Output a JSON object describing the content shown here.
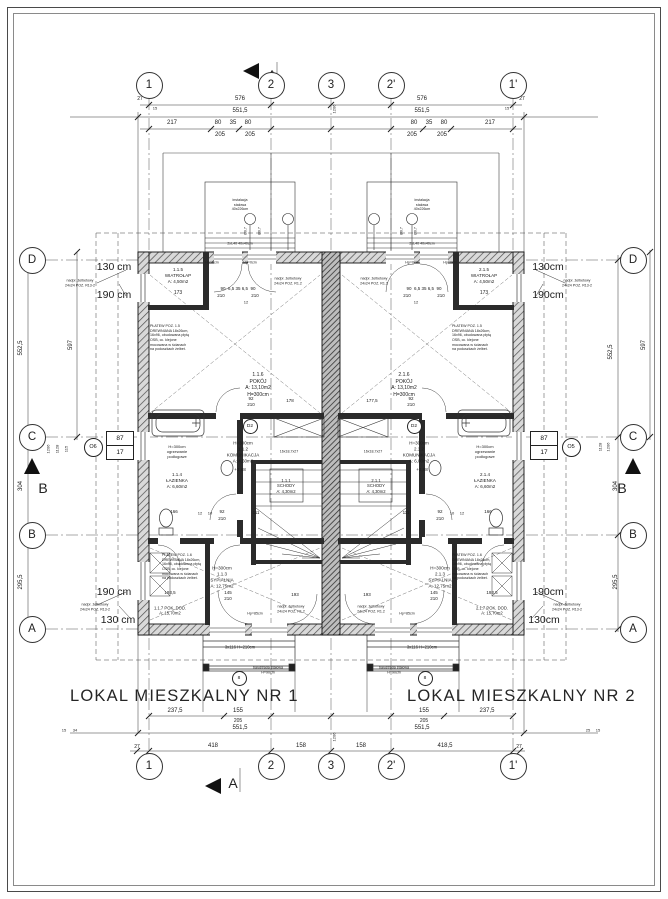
{
  "titles": {
    "nr1": "LOKAL MIESZKALNY NR 1",
    "nr2": "LOKAL MIESZKALNY  NR 2"
  },
  "axis_markers": {
    "top": [
      {
        "t": "1",
        "x": 149,
        "y": 85
      },
      {
        "t": "2",
        "x": 271,
        "y": 85
      },
      {
        "t": "3",
        "x": 331,
        "y": 85
      },
      {
        "t": "2'",
        "x": 391,
        "y": 85
      },
      {
        "t": "1'",
        "x": 513,
        "y": 85
      }
    ],
    "bottom": [
      {
        "t": "1",
        "x": 149,
        "y": 766
      },
      {
        "t": "2",
        "x": 271,
        "y": 766
      },
      {
        "t": "3",
        "x": 331,
        "y": 766
      },
      {
        "t": "2'",
        "x": 391,
        "y": 766
      },
      {
        "t": "1'",
        "x": 513,
        "y": 766
      }
    ],
    "left": [
      {
        "t": "D",
        "x": 32,
        "y": 260
      },
      {
        "t": "C",
        "x": 32,
        "y": 437
      },
      {
        "t": "B",
        "x": 32,
        "y": 535
      },
      {
        "t": "A",
        "x": 32,
        "y": 629
      }
    ],
    "right": [
      {
        "t": "D",
        "x": 633,
        "y": 260
      },
      {
        "t": "C",
        "x": 633,
        "y": 437
      },
      {
        "t": "B",
        "x": 633,
        "y": 535
      },
      {
        "t": "A",
        "x": 633,
        "y": 629
      }
    ]
  },
  "section_labels": [
    {
      "t": "A",
      "x": 272,
      "y": 75
    },
    {
      "t": "A",
      "x": 233,
      "y": 783
    },
    {
      "t": "B",
      "x": 43,
      "y": 488
    },
    {
      "t": "B",
      "x": 622,
      "y": 488
    }
  ],
  "contours": [
    {
      "t": "130 cm",
      "x": 114,
      "y": 268,
      "s": 10.5
    },
    {
      "t": "190 cm",
      "x": 114,
      "y": 296,
      "s": 10.5
    },
    {
      "t": "130cm",
      "x": 548,
      "y": 268,
      "s": 10.5
    },
    {
      "t": "190cm",
      "x": 548,
      "y": 296,
      "s": 10.5
    },
    {
      "t": "190 cm",
      "x": 114,
      "y": 593,
      "s": 10.5
    },
    {
      "t": "130 cm",
      "x": 118,
      "y": 621,
      "s": 10.5
    },
    {
      "t": "190cm",
      "x": 548,
      "y": 593,
      "s": 10.5
    },
    {
      "t": "130cm",
      "x": 544,
      "y": 621,
      "s": 10.5
    }
  ],
  "dimensions": [
    {
      "t": "576",
      "x": 240,
      "y": 100,
      "s": 6
    },
    {
      "t": "576",
      "x": 422,
      "y": 100,
      "s": 6
    },
    {
      "t": "551,5",
      "x": 240,
      "y": 112,
      "s": 6
    },
    {
      "t": "551,5",
      "x": 422,
      "y": 112,
      "s": 6
    },
    {
      "t": "27",
      "x": 140,
      "y": 99,
      "s": 5
    },
    {
      "t": "15",
      "x": 155,
      "y": 108,
      "s": 4
    },
    {
      "t": "1206",
      "x": 334,
      "y": 109,
      "s": 4,
      "r": -90
    },
    {
      "t": "15",
      "x": 507,
      "y": 108,
      "s": 4
    },
    {
      "t": "27",
      "x": 522,
      "y": 99,
      "s": 5
    },
    {
      "t": "217",
      "x": 172,
      "y": 124,
      "s": 6
    },
    {
      "t": "80",
      "x": 218,
      "y": 124,
      "s": 6
    },
    {
      "t": "35",
      "x": 233,
      "y": 124,
      "s": 6
    },
    {
      "t": "80",
      "x": 248,
      "y": 124,
      "s": 6
    },
    {
      "t": "80",
      "x": 414,
      "y": 124,
      "s": 6
    },
    {
      "t": "35",
      "x": 429,
      "y": 124,
      "s": 6
    },
    {
      "t": "80",
      "x": 444,
      "y": 124,
      "s": 6
    },
    {
      "t": "217",
      "x": 490,
      "y": 124,
      "s": 6
    },
    {
      "t": "205",
      "x": 220,
      "y": 136,
      "s": 6
    },
    {
      "t": "205",
      "x": 250,
      "y": 136,
      "s": 6
    },
    {
      "t": "205",
      "x": 412,
      "y": 136,
      "s": 6
    },
    {
      "t": "205",
      "x": 442,
      "y": 136,
      "s": 6
    },
    {
      "t": "237,5",
      "x": 175,
      "y": 712,
      "s": 6
    },
    {
      "t": "155",
      "x": 238,
      "y": 712,
      "s": 6
    },
    {
      "t": "155",
      "x": 424,
      "y": 712,
      "s": 6
    },
    {
      "t": "237,5",
      "x": 487,
      "y": 712,
      "s": 6
    },
    {
      "t": "205",
      "x": 238,
      "y": 721,
      "s": 5
    },
    {
      "t": "205",
      "x": 424,
      "y": 721,
      "s": 5
    },
    {
      "t": "551,5",
      "x": 240,
      "y": 729,
      "s": 6
    },
    {
      "t": "551,5",
      "x": 422,
      "y": 729,
      "s": 6
    },
    {
      "t": "1206",
      "x": 334,
      "y": 737,
      "s": 4,
      "r": -90
    },
    {
      "t": "15",
      "x": 64,
      "y": 730,
      "s": 4
    },
    {
      "t": "34",
      "x": 75,
      "y": 730,
      "s": 4
    },
    {
      "t": "25",
      "x": 588,
      "y": 730,
      "s": 4
    },
    {
      "t": "15",
      "x": 598,
      "y": 730,
      "s": 4
    },
    {
      "t": "27",
      "x": 137,
      "y": 747,
      "s": 5
    },
    {
      "t": "418",
      "x": 213,
      "y": 747,
      "s": 6
    },
    {
      "t": "158",
      "x": 301,
      "y": 747,
      "s": 6
    },
    {
      "t": "158",
      "x": 361,
      "y": 747,
      "s": 6
    },
    {
      "t": "418,5",
      "x": 445,
      "y": 747,
      "s": 6
    },
    {
      "t": "27",
      "x": 519,
      "y": 747,
      "s": 5
    },
    {
      "t": "552,5",
      "x": 22,
      "y": 348,
      "s": 6,
      "r": -90
    },
    {
      "t": "304",
      "x": 22,
      "y": 486,
      "s": 6,
      "r": -90
    },
    {
      "t": "295,5",
      "x": 22,
      "y": 582,
      "s": 6,
      "r": -90
    },
    {
      "t": "597",
      "x": 72,
      "y": 345,
      "s": 6,
      "r": -90
    },
    {
      "t": "115",
      "x": 66,
      "y": 449,
      "s": 4,
      "r": -90
    },
    {
      "t": "1128",
      "x": 57,
      "y": 449,
      "s": 4,
      "r": -90
    },
    {
      "t": "1206",
      "x": 48,
      "y": 449,
      "s": 4,
      "r": -90
    },
    {
      "t": "552,5",
      "x": 612,
      "y": 352,
      "s": 6,
      "r": -90
    },
    {
      "t": "597",
      "x": 645,
      "y": 345,
      "s": 6,
      "r": -90
    },
    {
      "t": "304",
      "x": 617,
      "y": 486,
      "s": 6,
      "r": -90
    },
    {
      "t": "295,5",
      "x": 617,
      "y": 582,
      "s": 6,
      "r": -90
    },
    {
      "t": "1128",
      "x": 600,
      "y": 447,
      "s": 4,
      "r": -90
    },
    {
      "t": "1206",
      "x": 608,
      "y": 447,
      "s": 4,
      "r": -90
    },
    {
      "t": "173",
      "x": 178,
      "y": 293,
      "s": 5
    },
    {
      "t": "173",
      "x": 484,
      "y": 293,
      "s": 5
    },
    {
      "t": "90  6,5 35 6,5  90",
      "x": 238,
      "y": 289,
      "s": 4.5
    },
    {
      "t": "90  6,5 35 6,5  90",
      "x": 424,
      "y": 289,
      "s": 4.5
    },
    {
      "t": "210",
      "x": 221,
      "y": 296,
      "s": 4.5
    },
    {
      "t": "210",
      "x": 255,
      "y": 296,
      "s": 4.5
    },
    {
      "t": "210",
      "x": 407,
      "y": 296,
      "s": 4.5
    },
    {
      "t": "210",
      "x": 441,
      "y": 296,
      "s": 4.5
    },
    {
      "t": "12",
      "x": 246,
      "y": 302,
      "s": 4
    },
    {
      "t": "12",
      "x": 416,
      "y": 302,
      "s": 4
    },
    {
      "t": "92",
      "x": 251,
      "y": 399,
      "s": 4.5
    },
    {
      "t": "210",
      "x": 251,
      "y": 405,
      "s": 4.5
    },
    {
      "t": "178",
      "x": 290,
      "y": 401,
      "s": 4.5
    },
    {
      "t": "92",
      "x": 411,
      "y": 399,
      "s": 4.5
    },
    {
      "t": "210",
      "x": 411,
      "y": 405,
      "s": 4.5
    },
    {
      "t": "177,5",
      "x": 372,
      "y": 401,
      "s": 4.5
    },
    {
      "t": "+2,88",
      "x": 240,
      "y": 470,
      "s": 4.5
    },
    {
      "t": "+2,88",
      "x": 422,
      "y": 470,
      "s": 4.5
    },
    {
      "t": "166",
      "x": 174,
      "y": 512,
      "s": 4.5
    },
    {
      "t": "12",
      "x": 200,
      "y": 513,
      "s": 4
    },
    {
      "t": "10",
      "x": 210,
      "y": 513,
      "s": 4
    },
    {
      "t": "92",
      "x": 222,
      "y": 512,
      "s": 4.5
    },
    {
      "t": "210",
      "x": 222,
      "y": 519,
      "s": 4.5
    },
    {
      "t": "111",
      "x": 256,
      "y": 513,
      "s": 4.5
    },
    {
      "t": "166",
      "x": 488,
      "y": 512,
      "s": 4.5
    },
    {
      "t": "12",
      "x": 462,
      "y": 513,
      "s": 4
    },
    {
      "t": "10",
      "x": 452,
      "y": 513,
      "s": 4
    },
    {
      "t": "92",
      "x": 440,
      "y": 512,
      "s": 4.5
    },
    {
      "t": "210",
      "x": 440,
      "y": 519,
      "s": 4.5
    },
    {
      "t": "111",
      "x": 406,
      "y": 513,
      "s": 4.5
    },
    {
      "t": "145",
      "x": 228,
      "y": 593,
      "s": 4.5
    },
    {
      "t": "210",
      "x": 228,
      "y": 599,
      "s": 4.5
    },
    {
      "t": "145",
      "x": 434,
      "y": 593,
      "s": 4.5
    },
    {
      "t": "210",
      "x": 434,
      "y": 599,
      "s": 4.5
    },
    {
      "t": "193,5",
      "x": 170,
      "y": 593,
      "s": 4.5
    },
    {
      "t": "193",
      "x": 295,
      "y": 595,
      "s": 4.5
    },
    {
      "t": "193",
      "x": 367,
      "y": 595,
      "s": 4.5
    },
    {
      "t": "193,5",
      "x": 492,
      "y": 593,
      "s": 4.5
    },
    {
      "t": "16x18,7x27",
      "x": 289,
      "y": 452,
      "s": 3.6
    },
    {
      "t": "16x18,7x27",
      "x": 373,
      "y": 452,
      "s": 3.6
    },
    {
      "t": "Ø0,7",
      "x": 246,
      "y": 231,
      "s": 3.6,
      "r": -90
    },
    {
      "t": "Ø0,7",
      "x": 260,
      "y": 231,
      "s": 3.6,
      "r": -90
    },
    {
      "t": "Ø0,7",
      "x": 402,
      "y": 231,
      "s": 3.6,
      "r": -90
    },
    {
      "t": "Ø0,7",
      "x": 416,
      "y": 231,
      "s": 3.6,
      "r": -90
    },
    {
      "t": "2xL40 40x40cm",
      "x": 240,
      "y": 244,
      "s": 3.6
    },
    {
      "t": "2xL40 40x40cm",
      "x": 422,
      "y": 244,
      "s": 3.6
    },
    {
      "t": "3x116 H=210cm",
      "x": 240,
      "y": 647,
      "s": 4.2
    },
    {
      "t": "3x116 H=210cm",
      "x": 422,
      "y": 647,
      "s": 4.2
    },
    {
      "t": "Hp=0cm",
      "x": 212,
      "y": 263,
      "s": 3.6
    },
    {
      "t": "Hp=0cm",
      "x": 250,
      "y": 263,
      "s": 3.6
    },
    {
      "t": "Hp=0cm",
      "x": 412,
      "y": 263,
      "s": 3.6
    },
    {
      "t": "Hp=0cm",
      "x": 450,
      "y": 263,
      "s": 3.6
    },
    {
      "t": "Hp=85cm",
      "x": 255,
      "y": 614,
      "s": 3.6
    },
    {
      "t": "Hp=85cm",
      "x": 407,
      "y": 614,
      "s": 3.6
    }
  ],
  "rooms": [
    {
      "l": [
        "1.1.5",
        "WIATROŁAP",
        "A: 4,50m2"
      ],
      "x": 178,
      "y": 276,
      "s": 4.5
    },
    {
      "l": [
        "2.1.5",
        "WIATROŁAP",
        "A: 4,50m2"
      ],
      "x": 484,
      "y": 276,
      "s": 4.5
    },
    {
      "l": [
        "1.1.6",
        "POKÓJ",
        "A: 13,10m2",
        "H=300cm"
      ],
      "x": 258,
      "y": 385,
      "s": 5
    },
    {
      "l": [
        "2.1.6",
        "POKÓJ",
        "A: 13,10m2",
        "H=300cm"
      ],
      "x": 404,
      "y": 385,
      "s": 5
    },
    {
      "l": [
        "H=300cm",
        "1.1.2",
        "KOMUNIKACJA",
        "A: 4,60m2"
      ],
      "x": 243,
      "y": 452,
      "s": 4.5
    },
    {
      "l": [
        "H=300cm",
        "2.1.2",
        "KOMUNIKACJA",
        "A: 6,00m2"
      ],
      "x": 419,
      "y": 452,
      "s": 4.5
    },
    {
      "l": [
        "H=300cm",
        "ogrzewanie",
        "podłogowe"
      ],
      "x": 177,
      "y": 452,
      "s": 4
    },
    {
      "l": [
        "H=300cm",
        "ogrzewanie",
        "podłogowe"
      ],
      "x": 485,
      "y": 452,
      "s": 4
    },
    {
      "l": [
        "1.1.4",
        "ŁAZIENKA",
        "A: 6,60m2"
      ],
      "x": 177,
      "y": 481,
      "s": 4.5
    },
    {
      "l": [
        "2.1.4",
        "ŁAZIENKA",
        "A: 6,60m2"
      ],
      "x": 485,
      "y": 481,
      "s": 4.5
    },
    {
      "l": [
        "1.1.1",
        "SCHODY",
        "A: 4,30m2"
      ],
      "x": 286,
      "y": 486,
      "s": 4.2
    },
    {
      "l": [
        "2.1.1",
        "SCHODY",
        "A: 4,30m2"
      ],
      "x": 376,
      "y": 486,
      "s": 4.2
    },
    {
      "l": [
        "H=300cm",
        "1.1.3",
        "SYPIALNIA",
        "A: 12,75m2"
      ],
      "x": 222,
      "y": 577,
      "s": 4.5
    },
    {
      "l": [
        "H=300cm",
        "2.1.3",
        "SYPIALNIA",
        "A: 12,75m2"
      ],
      "x": 440,
      "y": 577,
      "s": 4.5
    },
    {
      "l": [
        "1.1.7 POK. DOD.",
        "A: 15,70m2"
      ],
      "x": 170,
      "y": 611,
      "s": 4.2
    },
    {
      "l": [
        "2.1.7 POK. DOD.",
        "A: 15,70m2"
      ],
      "x": 492,
      "y": 611,
      "s": 4.2
    }
  ],
  "annotations": [
    {
      "l": [
        "nadpr. żelbetowy",
        "24x24 POZ. R13-2"
      ],
      "x": 80,
      "y": 283,
      "s": 3.6
    },
    {
      "l": [
        "nadpr. żelbetowy",
        "24x24 POZ. R13-2"
      ],
      "x": 577,
      "y": 283,
      "s": 3.6
    },
    {
      "l": [
        "nadpr. żelbetowy",
        "24x24 POZ. R13-2"
      ],
      "x": 95,
      "y": 607,
      "s": 3.6
    },
    {
      "l": [
        "nadpr. żelbetowy",
        "24x24 POZ. R13-2"
      ],
      "x": 567,
      "y": 607,
      "s": 3.6
    },
    {
      "l": [
        "nadpr. żelbetowy",
        "24x24 POZ. R1.2"
      ],
      "x": 288,
      "y": 281,
      "s": 3.6
    },
    {
      "l": [
        "nadpr. żelbetowy",
        "24x24 POZ. R1.2"
      ],
      "x": 374,
      "y": 281,
      "s": 3.6
    },
    {
      "l": [
        "nadpr. żelbetowy",
        "24x24 POZ. R1.2"
      ],
      "x": 291,
      "y": 609,
      "s": 3.6
    },
    {
      "l": [
        "nadpr. żelbetowy",
        "24x24 POZ. R1.2"
      ],
      "x": 371,
      "y": 609,
      "s": 3.6
    },
    {
      "l": [
        "PŁATEW POZ. 1.5",
        "DREWNIANA 18x26cm,",
        "16x96, obudowana płytą",
        "OSB, cc. klejone",
        "mocowana w ścianach",
        "na poduszkach żelbet."
      ],
      "x": 150,
      "y": 324,
      "s": 3.6,
      "a": "l"
    },
    {
      "l": [
        "PŁATEW POZ. 1.5",
        "DREWNIANA 18x26cm,",
        "16x96, obudowana płytą",
        "OSB, cc. klejone",
        "mocowana w ścianach",
        "na poduszkach żelbet."
      ],
      "x": 452,
      "y": 324,
      "s": 3.6,
      "a": "l"
    },
    {
      "l": [
        "PŁATEW POZ. 1.6",
        "DREWNIANA 18x26cm,",
        "16x96, obudowana płytą",
        "OSB, cc. klejone",
        "mocowana w ścianach",
        "na poduszkach żelbet."
      ],
      "x": 162,
      "y": 553,
      "s": 3.6,
      "a": "l"
    },
    {
      "l": [
        "PŁATEW POZ. 1.6",
        "DREWNIANA 18x26cm,",
        "16x96, obudowana płytą",
        "OSB, cc. klejone",
        "mocowana w ścianach",
        "na poduszkach żelbet."
      ],
      "x": 452,
      "y": 553,
      "s": 3.6,
      "a": "l"
    },
    {
      "l": [
        "instalacja",
        "stalowa",
        "40x226cm"
      ],
      "x": 240,
      "y": 205,
      "s": 3.6
    },
    {
      "l": [
        "instalacja",
        "stalowa",
        "40x226cm"
      ],
      "x": 422,
      "y": 205,
      "s": 3.6
    },
    {
      "l": [
        "balustrada stalowa",
        "H=90cm"
      ],
      "x": 268,
      "y": 670,
      "s": 3.6
    },
    {
      "l": [
        "balustrada stalowa",
        "H=90cm"
      ],
      "x": 394,
      "y": 670,
      "s": 3.6
    }
  ],
  "window_tags": [
    {
      "tag": "O6",
      "top": "87",
      "bottom": "17",
      "cx": 92,
      "cy": 446,
      "bx": 106,
      "by": 431
    },
    {
      "tag": "O5",
      "top": "87",
      "bottom": "17",
      "cx": 570,
      "cy": 446,
      "bx": 530,
      "by": 431
    }
  ],
  "circle_tags": [
    {
      "t": "D2",
      "x": 249,
      "y": 425
    },
    {
      "t": "D2",
      "x": 413,
      "y": 425
    },
    {
      "t": "8",
      "x": 238,
      "y": 677
    },
    {
      "t": "8",
      "x": 424,
      "y": 677
    }
  ]
}
